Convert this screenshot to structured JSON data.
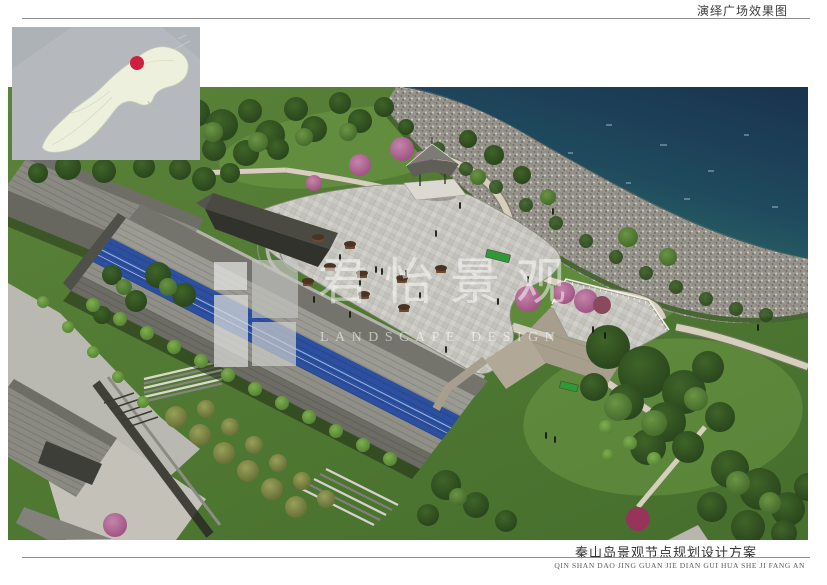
{
  "header": {
    "title": "演绎广场效果图"
  },
  "footer": {
    "project_title": "秦山岛景观节点规划设计方案",
    "project_title_pinyin": "QIN SHAN DAO JING GUAN JIE DIAN GUI HUA SHE JI FANG AN"
  },
  "watermark": {
    "cn_name": "君怡景观",
    "en_name": "LANDSCAPE DESIGN"
  },
  "inset_map": {
    "marker_icon": "red-location-dot"
  },
  "colors": {
    "sea_deep": "#1a3450",
    "sea_shallow": "#2f7668",
    "beach_rock": "#96948c",
    "grass": "#5a8238",
    "grass_dark": "#47702e",
    "plaza_paving": "#c9c8c2",
    "path_stone": "#d6cfbb",
    "roof_gray": "#8a8a82",
    "roof_dark": "#3e3e38",
    "solar_panel_blue": "#2c4f9f",
    "tree_pink": "#c585ab",
    "stone_wall": "#a89e8d",
    "map_sea": "#b5b9be",
    "map_island": "#edf0dc",
    "marker_red": "#cf1f3e",
    "rule": "#8f8f8f",
    "title_text": "#3c3c3c"
  }
}
